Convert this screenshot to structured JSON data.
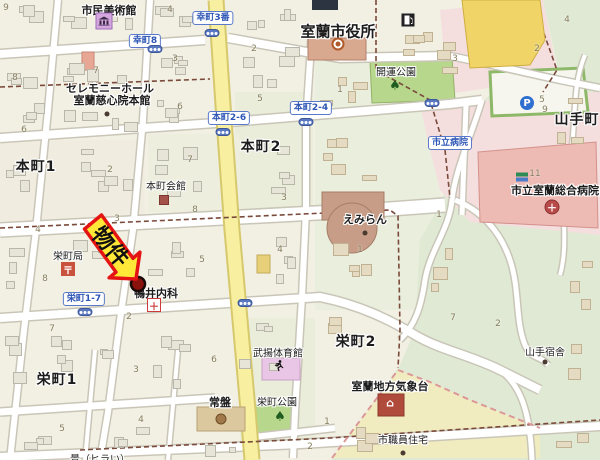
{
  "map": {
    "colors": {
      "base": "#f2efe3",
      "block_green": "#e9edda",
      "park": "#b7d78c",
      "forest": "#e0e9d4",
      "campus_pink": "#f4dede",
      "hospital_building": "#eebab4",
      "weather_zone": "#f1ecc0",
      "major_road_yellow": "#f8f0a0",
      "road_white": "#ffffff",
      "road_casing": "#c9c6b8",
      "boundary_dash": "#7a4a3a",
      "zone_dash_pink": "#dc9898",
      "arrow_fill": "#ffe838",
      "arrow_border": "#e41414",
      "property_dot": "#8a120c"
    },
    "district_labels": [
      {
        "text": "本町1",
        "x": 36,
        "y": 166
      },
      {
        "text": "本町2",
        "x": 261,
        "y": 146
      },
      {
        "text": "栄町1",
        "x": 57,
        "y": 379
      },
      {
        "text": "栄町2",
        "x": 356,
        "y": 341
      },
      {
        "text": "山手町",
        "x": 577,
        "y": 119
      }
    ],
    "facility_labels": [
      {
        "text": "市民美術館",
        "x": 109,
        "y": 10,
        "bold": true
      },
      {
        "text": "室蘭市役所",
        "x": 338,
        "y": 31,
        "bold": true,
        "size": 15
      },
      {
        "text": "セレモニーホール",
        "x": 110,
        "y": 88,
        "bold": true
      },
      {
        "text": "室蘭慈心院本館",
        "x": 112,
        "y": 100,
        "bold": true
      },
      {
        "text": "開運公園",
        "x": 396,
        "y": 71
      },
      {
        "text": "本町会館",
        "x": 166,
        "y": 185
      },
      {
        "text": "えみらん",
        "x": 365,
        "y": 219,
        "bold": true
      },
      {
        "text": "市立室蘭総合病院",
        "x": 555,
        "y": 190,
        "bold": true
      },
      {
        "text": "武揚体育館",
        "x": 278,
        "y": 352
      },
      {
        "text": "栄町公園",
        "x": 277,
        "y": 401
      },
      {
        "text": "常盤",
        "x": 220,
        "y": 402,
        "bold": true
      },
      {
        "text": "栄町局",
        "x": 68,
        "y": 255
      },
      {
        "text": "鴨井内科",
        "x": 156,
        "y": 293,
        "bold": true
      },
      {
        "text": "室蘭地方気象台",
        "x": 390,
        "y": 386,
        "bold": true
      },
      {
        "text": "市職員住宅",
        "x": 403,
        "y": 439
      },
      {
        "text": "山手宿舎",
        "x": 545,
        "y": 351
      },
      {
        "text": "景（ヒラい）",
        "x": 100,
        "y": 458
      }
    ],
    "bus_stop_labels": [
      {
        "text": "幸町8",
        "x": 145,
        "y": 41
      },
      {
        "text": "幸町3番",
        "x": 213,
        "y": 18
      },
      {
        "text": "本町2-6",
        "x": 229,
        "y": 118
      },
      {
        "text": "本町2-4",
        "x": 311,
        "y": 108
      },
      {
        "text": "市立病院",
        "x": 450,
        "y": 143
      },
      {
        "text": "栄町1-7",
        "x": 84,
        "y": 299
      }
    ],
    "block_numbers": [
      {
        "t": "9",
        "x": 6,
        "y": 8
      },
      {
        "t": "4",
        "x": 170,
        "y": 10
      },
      {
        "t": "2",
        "x": 254,
        "y": 49
      },
      {
        "t": "3",
        "x": 175,
        "y": 59
      },
      {
        "t": "7",
        "x": 96,
        "y": 71
      },
      {
        "t": "8",
        "x": 15,
        "y": 78
      },
      {
        "t": "5",
        "x": 260,
        "y": 99
      },
      {
        "t": "6",
        "x": 180,
        "y": 107
      },
      {
        "t": "1",
        "x": 340,
        "y": 90
      },
      {
        "t": "3",
        "x": 455,
        "y": 59
      },
      {
        "t": "2",
        "x": 537,
        "y": 49
      },
      {
        "t": "4",
        "x": 567,
        "y": 20
      },
      {
        "t": "5",
        "x": 542,
        "y": 100
      },
      {
        "t": "9",
        "x": 545,
        "y": 110
      },
      {
        "t": "11",
        "x": 535,
        "y": 174
      },
      {
        "t": "6",
        "x": 24,
        "y": 130
      },
      {
        "t": "2",
        "x": 110,
        "y": 170
      },
      {
        "t": "7",
        "x": 190,
        "y": 160
      },
      {
        "t": "3",
        "x": 284,
        "y": 198
      },
      {
        "t": "8",
        "x": 195,
        "y": 210
      },
      {
        "t": "3",
        "x": 117,
        "y": 219
      },
      {
        "t": "4",
        "x": 38,
        "y": 230
      },
      {
        "t": "5",
        "x": 202,
        "y": 260
      },
      {
        "t": "4",
        "x": 280,
        "y": 250
      },
      {
        "t": "1",
        "x": 360,
        "y": 250
      },
      {
        "t": "1",
        "x": 439,
        "y": 215
      },
      {
        "t": "8",
        "x": 45,
        "y": 279
      },
      {
        "t": "2",
        "x": 129,
        "y": 317
      },
      {
        "t": "7",
        "x": 52,
        "y": 329
      },
      {
        "t": "6",
        "x": 214,
        "y": 360
      },
      {
        "t": "3",
        "x": 136,
        "y": 370
      },
      {
        "t": "7",
        "x": 453,
        "y": 318
      },
      {
        "t": "2",
        "x": 498,
        "y": 324
      },
      {
        "t": "1",
        "x": 327,
        "y": 422
      },
      {
        "t": "5",
        "x": 62,
        "y": 429
      },
      {
        "t": "4",
        "x": 141,
        "y": 420
      },
      {
        "t": "2",
        "x": 310,
        "y": 447
      }
    ],
    "icons": [
      {
        "type": "signal",
        "x": 155,
        "y": 49
      },
      {
        "type": "signal",
        "x": 212,
        "y": 33
      },
      {
        "type": "signal",
        "x": 223,
        "y": 132
      },
      {
        "type": "signal",
        "x": 306,
        "y": 122
      },
      {
        "type": "signal",
        "x": 85,
        "y": 312
      },
      {
        "type": "signal",
        "x": 245,
        "y": 303
      },
      {
        "type": "signal",
        "x": 432,
        "y": 103
      },
      {
        "type": "parking",
        "x": 527,
        "y": 103,
        "glyph": "P"
      },
      {
        "type": "museum",
        "x": 104,
        "y": 21
      },
      {
        "type": "fuel",
        "x": 408,
        "y": 20
      },
      {
        "type": "cityhall",
        "x": 338,
        "y": 44
      },
      {
        "type": "post",
        "x": 68,
        "y": 269,
        "glyph": "〒"
      },
      {
        "type": "hall",
        "x": 164,
        "y": 200
      },
      {
        "type": "clinic",
        "x": 154,
        "y": 305,
        "glyph": "＋"
      },
      {
        "type": "hospital",
        "x": 552,
        "y": 207,
        "glyph": "＋"
      },
      {
        "type": "stripes",
        "x": 522,
        "y": 177
      },
      {
        "type": "tree",
        "x": 395,
        "y": 86,
        "glyph": "♠"
      },
      {
        "type": "tree",
        "x": 280,
        "y": 417,
        "glyph": "♠"
      },
      {
        "type": "runner",
        "x": 279,
        "y": 366
      },
      {
        "type": "weather",
        "x": 390,
        "y": 403,
        "glyph": "⌂"
      },
      {
        "type": "circle-facility",
        "x": 221,
        "y": 419
      },
      {
        "type": "dot",
        "x": 107,
        "y": 114
      },
      {
        "type": "dot",
        "x": 365,
        "y": 233
      },
      {
        "type": "dot",
        "x": 545,
        "y": 362
      },
      {
        "type": "dot",
        "x": 403,
        "y": 453
      }
    ],
    "property": {
      "arrow_text": "物件",
      "dot": {
        "x": 138,
        "y": 284
      }
    }
  }
}
